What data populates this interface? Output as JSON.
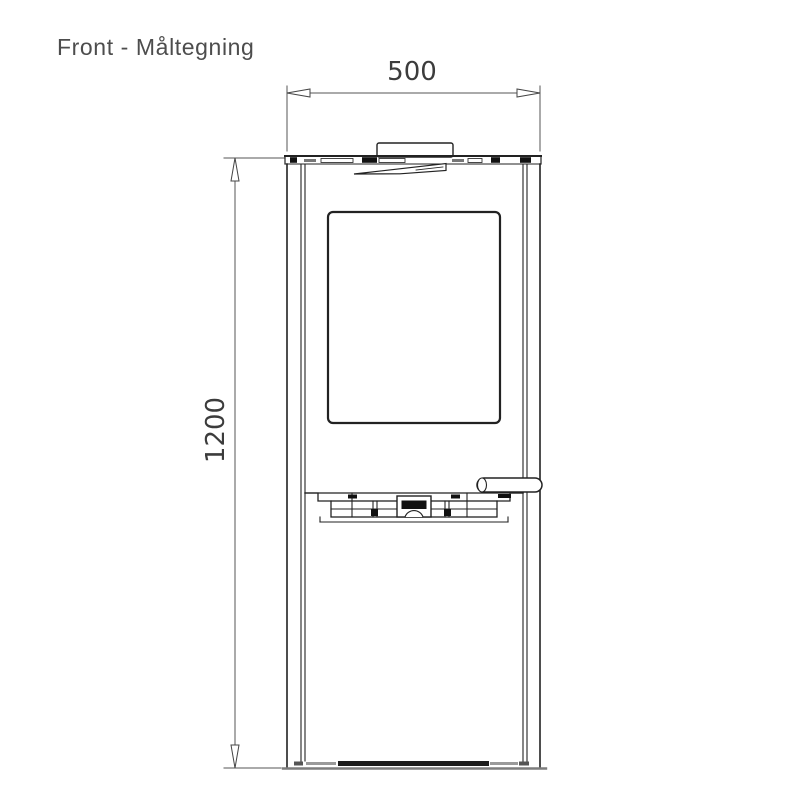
{
  "title": "Front - Måltegning",
  "dimension_labels": {
    "width": "500",
    "height": "1200"
  },
  "colors": {
    "background": "#ffffff",
    "drawing_line": "#222222",
    "dimension_line": "#555555",
    "dimension_text": "#3c3c3c",
    "title_text": "#4d4d4d",
    "base_muted_line": "#7d7d7d",
    "fill_dark_detail": "#111111"
  }
}
